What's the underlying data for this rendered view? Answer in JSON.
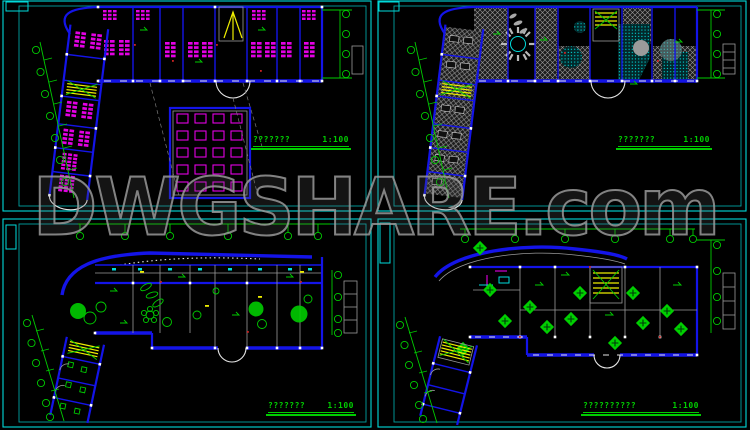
{
  "page": {
    "description": "CAD preview of four kindergarten floor plan sheets",
    "watermark": "DWGSHARE.com"
  },
  "palette": {
    "background": "#000000",
    "sheet_border": "#00d9d9",
    "wall_blue": "#1414e8",
    "furniture_magenta": "#e400e4",
    "annotation_green": "#00cc00",
    "stair_yellow": "#ecec00",
    "pool_cyan": "#00dcdc",
    "floor_gray": "#9a9a9a",
    "watermark_gray": "#8e8e8e",
    "column_white": "#ffffff",
    "accent_red": "#cc2222"
  },
  "sheets": [
    {
      "id": "top-left",
      "title": "???????",
      "scale": "1:100"
    },
    {
      "id": "top-right",
      "title": "???????",
      "scale": "1:100"
    },
    {
      "id": "bottom-left",
      "title": "???????",
      "scale": "1:100"
    },
    {
      "id": "bottom-right",
      "title": "??????????",
      "scale": "1:100"
    }
  ]
}
